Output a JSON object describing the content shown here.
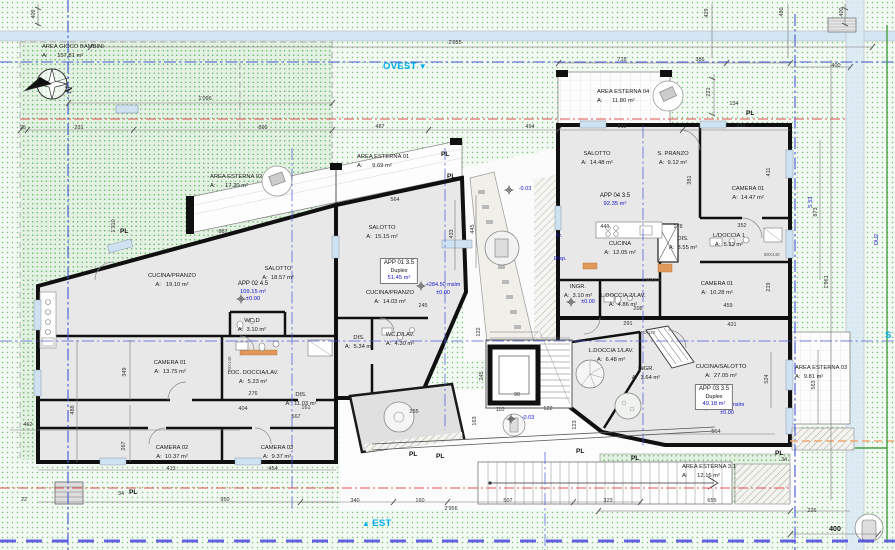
{
  "palette": {
    "accent_cyan": "#00aeef",
    "blue_text": "#1515cf",
    "boundary_blue": "#4356d6",
    "boundary_red": "#e05050",
    "boundary_green": "#46a046",
    "wall": "#101010",
    "room_fill": "#e8e8e8"
  },
  "compass": {
    "north": "N"
  },
  "directions": {
    "west": {
      "label": "OVEST",
      "arrow": "▼"
    },
    "east": {
      "label": "EST",
      "arrow": "▲"
    },
    "south": {
      "label": "S"
    }
  },
  "site_areas": [
    {
      "name": "AREA GIOCO BAMBINI",
      "area": "A:      157.81 m²",
      "x": 42,
      "y": 43
    },
    {
      "name": "AREA ESTERNA 02",
      "area": "A:      17.20 m²",
      "x": 210,
      "y": 173
    },
    {
      "name": "AREA ESTERNA 01",
      "area": "A:      9.69 m²",
      "x": 357,
      "y": 153
    },
    {
      "name": "AREA ESTERNA 04",
      "area": "A:      11.80 m²",
      "x": 597,
      "y": 88
    },
    {
      "name": "AREA ESTERNA 03",
      "area": "A:  9.81 m²",
      "x": 795,
      "y": 364
    },
    {
      "name": "AREA ESTERNA 3.1",
      "area": "A:      12.16 m²",
      "x": 682,
      "y": 463
    }
  ],
  "rooms": [
    {
      "name": "CUCINA/PRANZO",
      "area": "A:   19.10 m²",
      "x": 172,
      "y": 272
    },
    {
      "name": "SALOTTO",
      "area": "A:  18.57 m²",
      "x": 278,
      "y": 265
    },
    {
      "name": "WC.D",
      "area": "A:  3.10 m²",
      "x": 252,
      "y": 317
    },
    {
      "name": "CAMERA 01",
      "area": "A:  13.75 m²",
      "x": 170,
      "y": 359
    },
    {
      "name": "LOC. DOCCIA/LAV.",
      "area": "A:  5.23 m²",
      "x": 253,
      "y": 369
    },
    {
      "name": "DIS.",
      "area": "A:  11.03 m²",
      "x": 301,
      "y": 391
    },
    {
      "name": "CAMERA 02",
      "area": "A:  10.37 m²",
      "x": 172,
      "y": 444
    },
    {
      "name": "CAMERA 03",
      "area": "A:  9.37 m²",
      "x": 277,
      "y": 444
    },
    {
      "name": "SALOTTO",
      "area": "A:  15.15 m²",
      "x": 382,
      "y": 224
    },
    {
      "name": "CUCINA/PRANZO",
      "area": "A:  14.03 m²",
      "x": 390,
      "y": 289
    },
    {
      "name": "DIS.",
      "area": "A:  5.34 m²",
      "x": 359,
      "y": 334
    },
    {
      "name": "WC.D/LAV.",
      "area": "A:  4.30 m²",
      "x": 400,
      "y": 331
    },
    {
      "name": "SALOTTO",
      "area": "A:  14.48 m²",
      "x": 597,
      "y": 150
    },
    {
      "name": "S. PRANZO",
      "area": "A:  9.12 m²",
      "x": 673,
      "y": 150
    },
    {
      "name": "CAMERA 01",
      "area": "A:  14.47 m²",
      "x": 748,
      "y": 185
    },
    {
      "name": "CUCINA",
      "area": "A:  12.05 m²",
      "x": 620,
      "y": 240
    },
    {
      "name": "DIS.",
      "area": "A:  3.55 m²",
      "x": 683,
      "y": 235
    },
    {
      "name": "L/DOCCIA 1",
      "area": "A:  5.32 m²",
      "x": 729,
      "y": 232
    },
    {
      "name": "INGR.",
      "area": "A:  3.10 m²",
      "x": 578,
      "y": 283
    },
    {
      "name": "L.DOCCIA 2/LAV.",
      "area": "A:  4.86 m²",
      "x": 623,
      "y": 292
    },
    {
      "name": "CAMERA 01",
      "area": "A:  10.28 m²",
      "x": 717,
      "y": 280
    },
    {
      "name": "L.DOCCIA 1/LAV.",
      "area": "A:  6.48 m²",
      "x": 611,
      "y": 347
    },
    {
      "name": "INGR.",
      "area": "A:  3.64 m²",
      "x": 646,
      "y": 365
    },
    {
      "name": "CUCINA/SALOTTO",
      "area": "A:  27.05 m²",
      "x": 721,
      "y": 363
    }
  ],
  "apartments": [
    {
      "name": "APP 02  4.5",
      "size": "109.15 m²",
      "elev": "±0.00"
    },
    {
      "name": "APP 01  3.5",
      "type": "Duplex",
      "size": "51.45 m²"
    },
    {
      "name": "APP 04  3.5",
      "size": "92.35 m²"
    },
    {
      "name": "APP 03  3.5",
      "type": "Duplex",
      "size": "49.18 m²"
    }
  ],
  "elevation_marks": [
    {
      "l1": "+284.50 mslm",
      "l2": "±0.00",
      "x": 443,
      "y": 282
    },
    {
      "l1": "+284.50 mslm",
      "l2": "±0.00",
      "x": 727,
      "y": 402
    },
    {
      "l1": "-0.03",
      "l2": "",
      "x": 525,
      "y": 186
    },
    {
      "l1": "-0.03",
      "l2": "",
      "x": 528,
      "y": 415
    },
    {
      "l1": "±0.00",
      "l2": "",
      "x": 588,
      "y": 299
    }
  ],
  "pl_markers": [
    {
      "t": "PL",
      "x": 120,
      "y": 228
    },
    {
      "t": "PL",
      "x": 441,
      "y": 151
    },
    {
      "t": "PL",
      "x": 447,
      "y": 173
    },
    {
      "t": "PL",
      "x": 746,
      "y": 110
    },
    {
      "t": "PL",
      "x": 129,
      "y": 489
    },
    {
      "t": "PL",
      "x": 409,
      "y": 451
    },
    {
      "t": "PL",
      "x": 436,
      "y": 453
    },
    {
      "t": "PL",
      "x": 576,
      "y": 448
    },
    {
      "t": "PL",
      "x": 775,
      "y": 450
    },
    {
      "t": "PL",
      "x": 631,
      "y": 455
    }
  ],
  "dims": [
    {
      "t": "2'955",
      "x": 455,
      "y": 40
    },
    {
      "t": "1'096",
      "x": 205,
      "y": 96
    },
    {
      "t": "25",
      "x": 23,
      "y": 125
    },
    {
      "t": "231",
      "x": 79,
      "y": 125
    },
    {
      "t": "890",
      "x": 263,
      "y": 125
    },
    {
      "t": "487",
      "x": 380,
      "y": 124
    },
    {
      "t": "494",
      "x": 530,
      "y": 124
    },
    {
      "t": "718",
      "x": 622,
      "y": 57
    },
    {
      "t": "386",
      "x": 700,
      "y": 57
    },
    {
      "t": "400",
      "x": 836,
      "y": 63
    },
    {
      "t": "619",
      "x": 622,
      "y": 124
    },
    {
      "t": "352",
      "x": 741,
      "y": 123
    },
    {
      "t": "134",
      "x": 734,
      "y": 101
    },
    {
      "t": "887",
      "x": 223,
      "y": 229
    },
    {
      "t": "564",
      "x": 395,
      "y": 197
    },
    {
      "t": "441",
      "x": 605,
      "y": 224
    },
    {
      "t": "178",
      "x": 678,
      "y": 224
    },
    {
      "t": "352",
      "x": 742,
      "y": 223
    },
    {
      "t": "208",
      "x": 638,
      "y": 306
    },
    {
      "t": "459",
      "x": 728,
      "y": 303
    },
    {
      "t": "291",
      "x": 628,
      "y": 321
    },
    {
      "t": "431",
      "x": 732,
      "y": 322
    },
    {
      "t": "245",
      "x": 423,
      "y": 303
    },
    {
      "t": "404",
      "x": 243,
      "y": 406
    },
    {
      "t": "567",
      "x": 296,
      "y": 414
    },
    {
      "t": "276",
      "x": 253,
      "y": 391
    },
    {
      "t": "161",
      "x": 306,
      "y": 405
    },
    {
      "t": "413",
      "x": 171,
      "y": 466
    },
    {
      "t": "454",
      "x": 273,
      "y": 466
    },
    {
      "t": "950",
      "x": 225,
      "y": 497
    },
    {
      "t": "34",
      "x": 121,
      "y": 491
    },
    {
      "t": "22",
      "x": 24,
      "y": 497
    },
    {
      "t": "462",
      "x": 28,
      "y": 422
    },
    {
      "t": "340",
      "x": 355,
      "y": 498
    },
    {
      "t": "160",
      "x": 420,
      "y": 498
    },
    {
      "t": "507",
      "x": 508,
      "y": 498
    },
    {
      "t": "323",
      "x": 608,
      "y": 498
    },
    {
      "t": "2'956",
      "x": 451,
      "y": 506
    },
    {
      "t": "655",
      "x": 712,
      "y": 498
    },
    {
      "t": "226",
      "x": 812,
      "y": 508
    },
    {
      "t": "400",
      "x": 835,
      "y": 526,
      "b": 1
    },
    {
      "t": "564",
      "x": 716,
      "y": 429
    },
    {
      "t": "255",
      "x": 414,
      "y": 409
    },
    {
      "t": "110",
      "x": 500,
      "y": 407
    },
    {
      "t": "122",
      "x": 548,
      "y": 406
    },
    {
      "t": "90",
      "x": 517,
      "y": 392
    },
    {
      "t": "34",
      "x": 784,
      "y": 457
    },
    {
      "t": "409",
      "x": 34,
      "y": 14,
      "r": 1
    },
    {
      "t": "400",
      "x": 842,
      "y": 12,
      "r": 1
    },
    {
      "t": "429",
      "x": 707,
      "y": 13,
      "r": 1
    },
    {
      "t": "480",
      "x": 782,
      "y": 12,
      "r": 1
    },
    {
      "t": "221",
      "x": 709,
      "y": 92,
      "r": 1
    },
    {
      "t": "381",
      "x": 690,
      "y": 180,
      "r": 1
    },
    {
      "t": "411",
      "x": 769,
      "y": 172,
      "r": 1
    },
    {
      "t": "433",
      "x": 452,
      "y": 234,
      "r": 1
    },
    {
      "t": "445",
      "x": 473,
      "y": 229,
      "r": 1
    },
    {
      "t": "488",
      "x": 73,
      "y": 410,
      "r": 1
    },
    {
      "t": "349",
      "x": 125,
      "y": 372,
      "r": 1
    },
    {
      "t": "267",
      "x": 124,
      "y": 446,
      "r": 1
    },
    {
      "t": "563",
      "x": 814,
      "y": 385,
      "r": 1
    },
    {
      "t": "524",
      "x": 767,
      "y": 379,
      "r": 1
    },
    {
      "t": "163",
      "x": 475,
      "y": 421,
      "r": 1
    },
    {
      "t": "219",
      "x": 769,
      "y": 287,
      "r": 1
    },
    {
      "t": "123",
      "x": 575,
      "y": 425,
      "r": 1
    },
    {
      "t": "245",
      "x": 482,
      "y": 376,
      "r": 1
    },
    {
      "t": "873",
      "x": 816,
      "y": 212,
      "r": 1
    },
    {
      "t": "1'961",
      "x": 827,
      "y": 282,
      "r": 1
    },
    {
      "t": "1'310",
      "x": 114,
      "y": 226,
      "r": 1
    },
    {
      "t": "122",
      "x": 479,
      "y": 332,
      "r": 1
    }
  ],
  "fixtures": [
    {
      "t": "80X120",
      "x": 646,
      "y": 277
    },
    {
      "t": "70X110",
      "x": 640,
      "y": 330
    },
    {
      "t": "80X140",
      "x": 764,
      "y": 252
    },
    {
      "t": "80X140",
      "x": 227,
      "y": 372,
      "r": 1
    }
  ],
  "notes": [
    {
      "t": "Fr.",
      "x": 556,
      "y": 233
    },
    {
      "t": "Disp.",
      "x": 554,
      "y": 256
    },
    {
      "t": "S 53",
      "x": 808,
      "y": 208,
      "r": 1
    },
    {
      "t": "DU2",
      "x": 874,
      "y": 245,
      "r": 1
    }
  ]
}
